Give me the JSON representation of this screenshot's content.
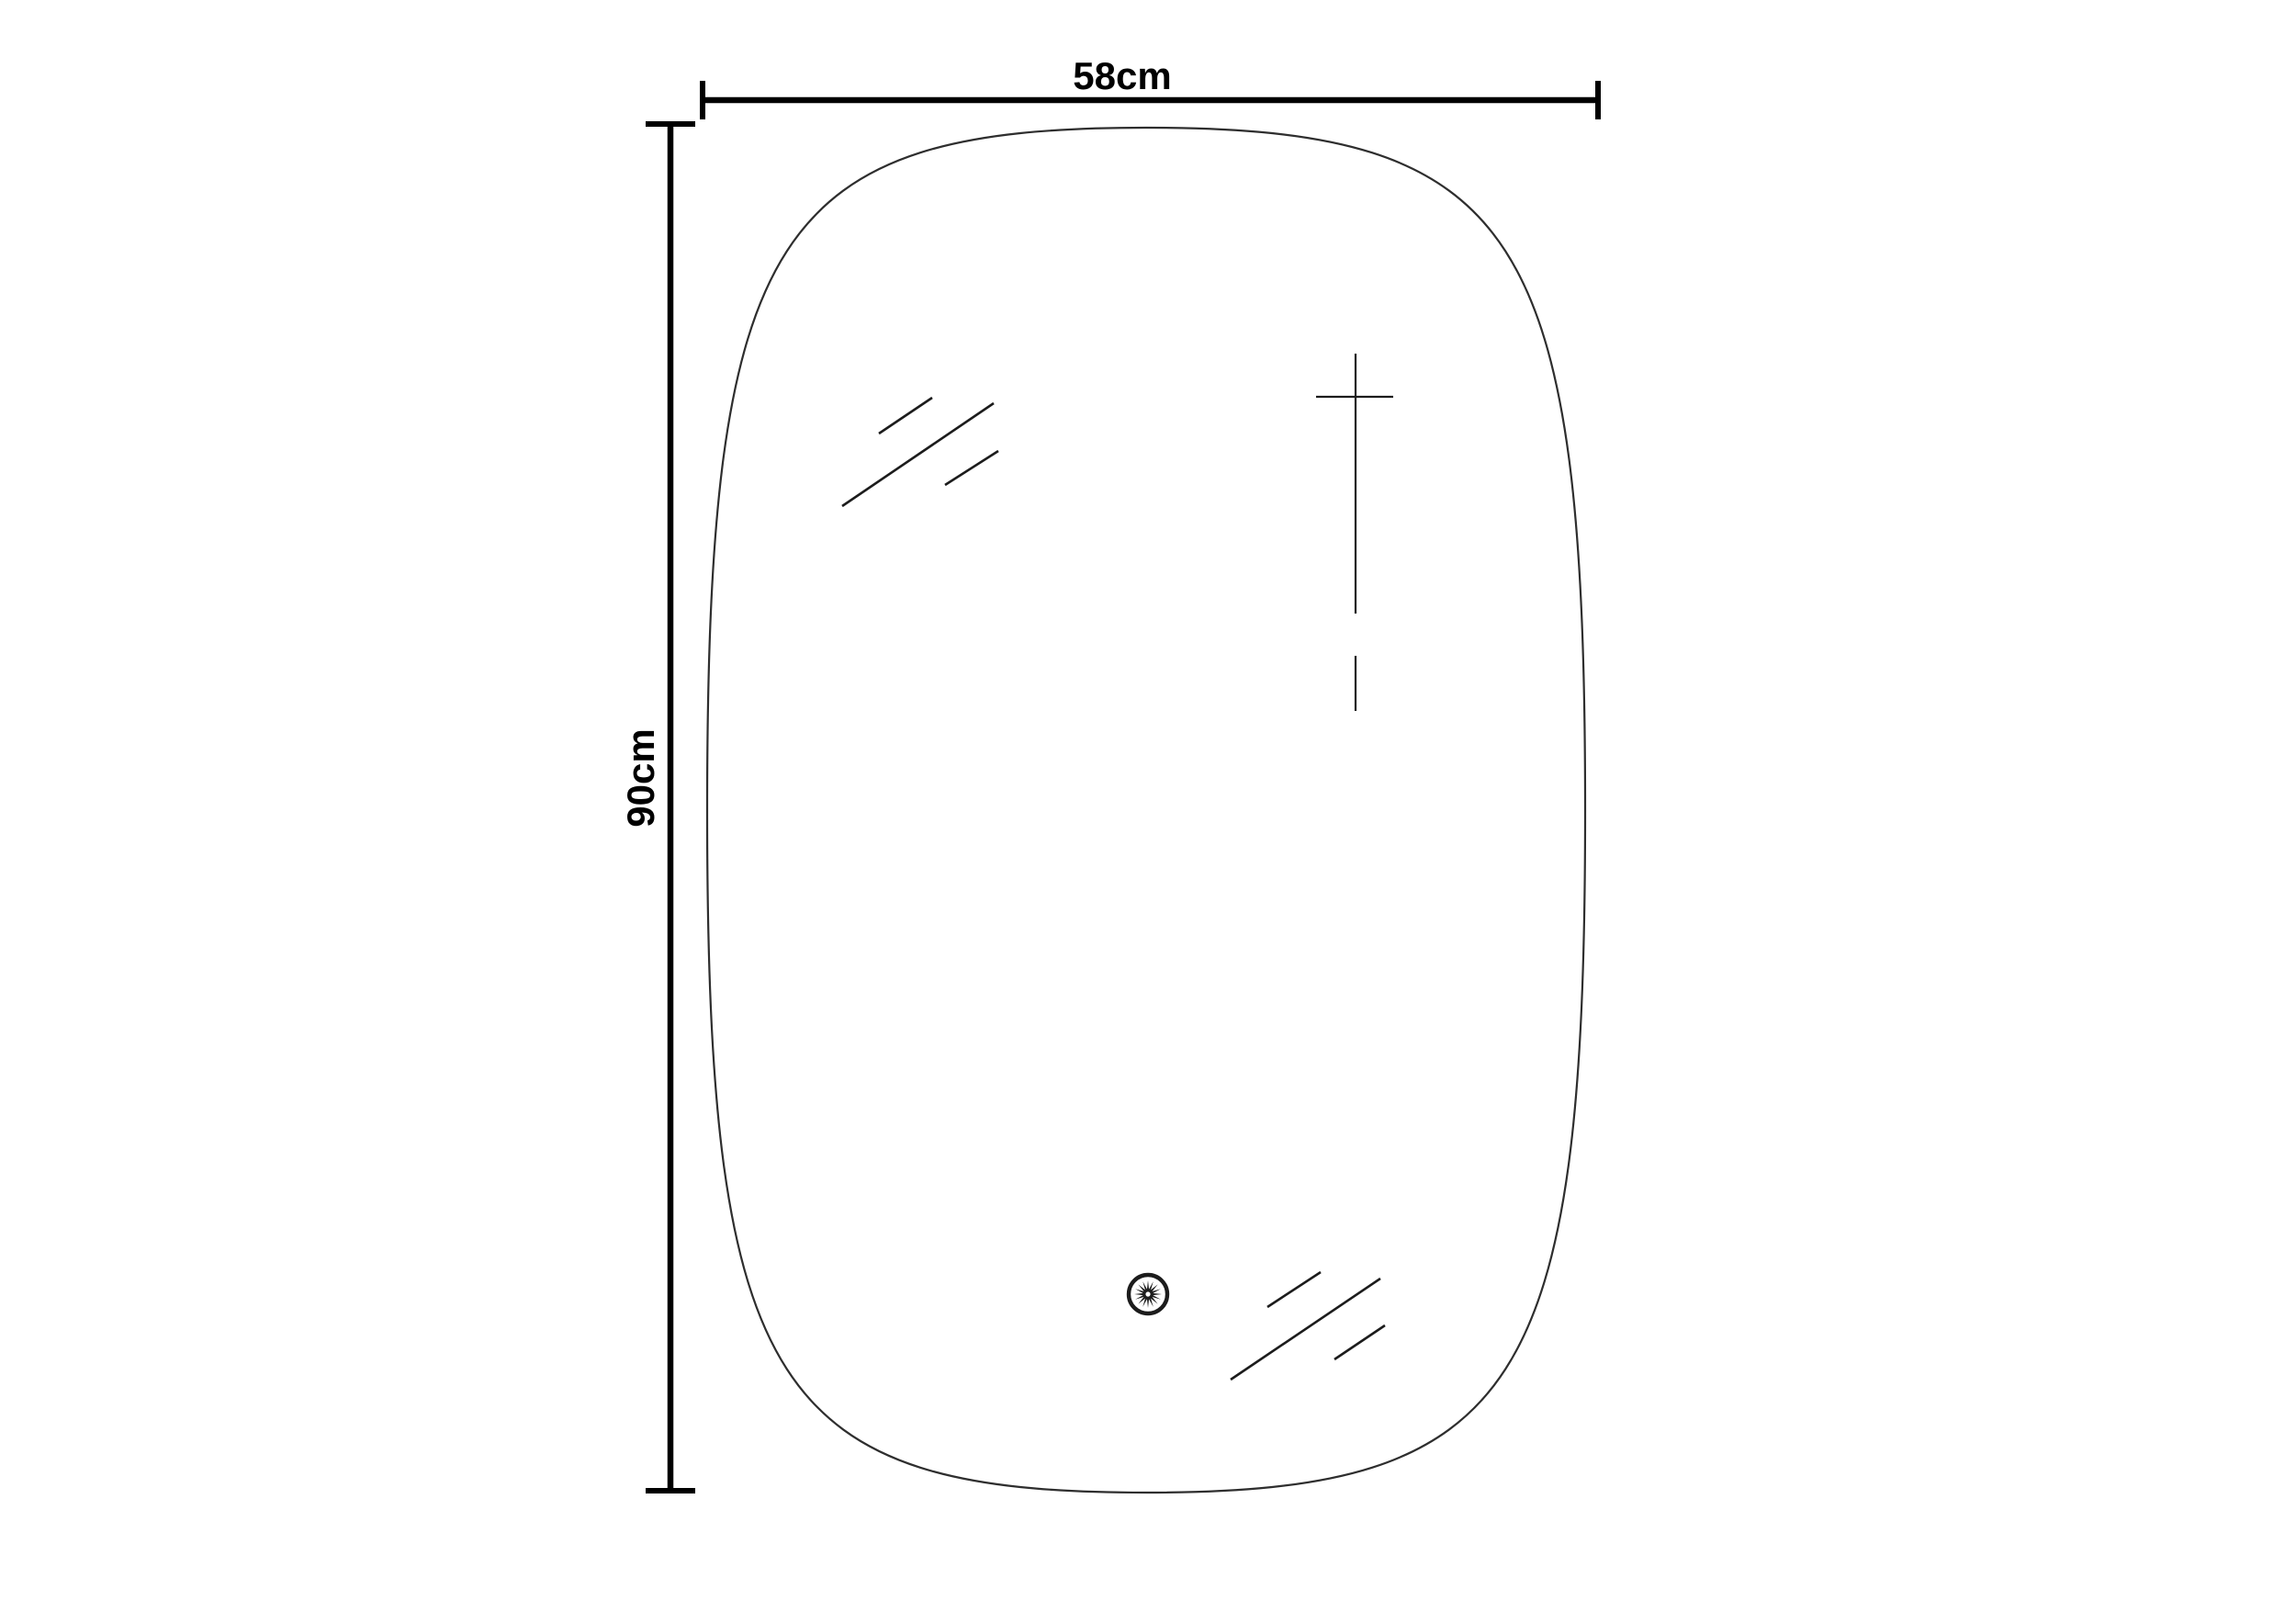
{
  "diagram": {
    "kind": "product-dimension-drawing",
    "subject": "rounded-rectangle-mirror"
  },
  "dimensions": {
    "width_label": "58cm",
    "height_label": "90cm",
    "width_cm": 58,
    "height_cm": 90
  },
  "icons": {
    "sensor": "touch-sensor-sunburst-icon",
    "reflections": "glass-shine-lines",
    "cross_mark": "cross-mark"
  },
  "colors": {
    "background": "#ffffff",
    "line": "#000000",
    "outline": "#2e2e2e",
    "detail": "#1c1c1c"
  }
}
